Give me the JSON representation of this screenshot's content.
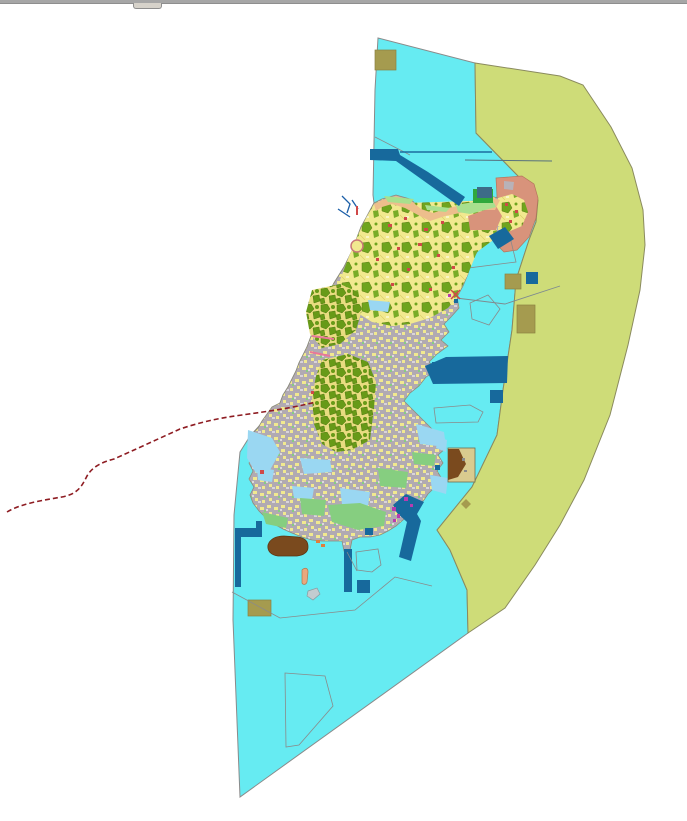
{
  "window": {
    "top_border": "window-top-border",
    "splitter_handle": "map-splitter-handle"
  },
  "map": {
    "type": "gis-land-use-zoning-map",
    "regions": {
      "sea_planning_area": "sea",
      "rural_zone_band": "rural",
      "island_urban_fabric": "urbanGray",
      "island_forest_parcels": "forestGreen",
      "harbor_port_structures": "harbor",
      "special_district": "salmon",
      "municipal_boundary_dashed": "boundaryDash"
    }
  },
  "colors": {
    "sea": "#66EBF2",
    "rural": "#CEDC78",
    "harbor": "#17699C",
    "khaki": "#A59B4F",
    "salmon": "#D8937B",
    "salmonParcel": "#B8B2B8",
    "islandYellow": "#F1E98F",
    "forestGreen": "#6FA41E",
    "denseGreen": "#679A18",
    "urbanGray": "#B1AAB2",
    "paleBlue": "#9AD7F2",
    "lightGreen": "#86CE80",
    "coastGreen": "#A8E08E",
    "peach": "#EDBE8C",
    "brown": "#7A4A1E",
    "tan": "#D9CB8F",
    "boundaryDash": "#8E1C22",
    "pink": "#E87898",
    "magenta": "#B93BB0",
    "red": "#D04848",
    "brightGreen": "#2FA83C",
    "slateBlue": "#3D6B88",
    "streamBlue": "#1C5FA8",
    "thinLineBlue": "#1C6CA0",
    "thinLineSlate": "#56707E",
    "outline": "#8A8A8A",
    "coastOutline": "#8C8C7A",
    "yellowSpeck": "#F1E98F",
    "white": "#FFFFFF"
  }
}
